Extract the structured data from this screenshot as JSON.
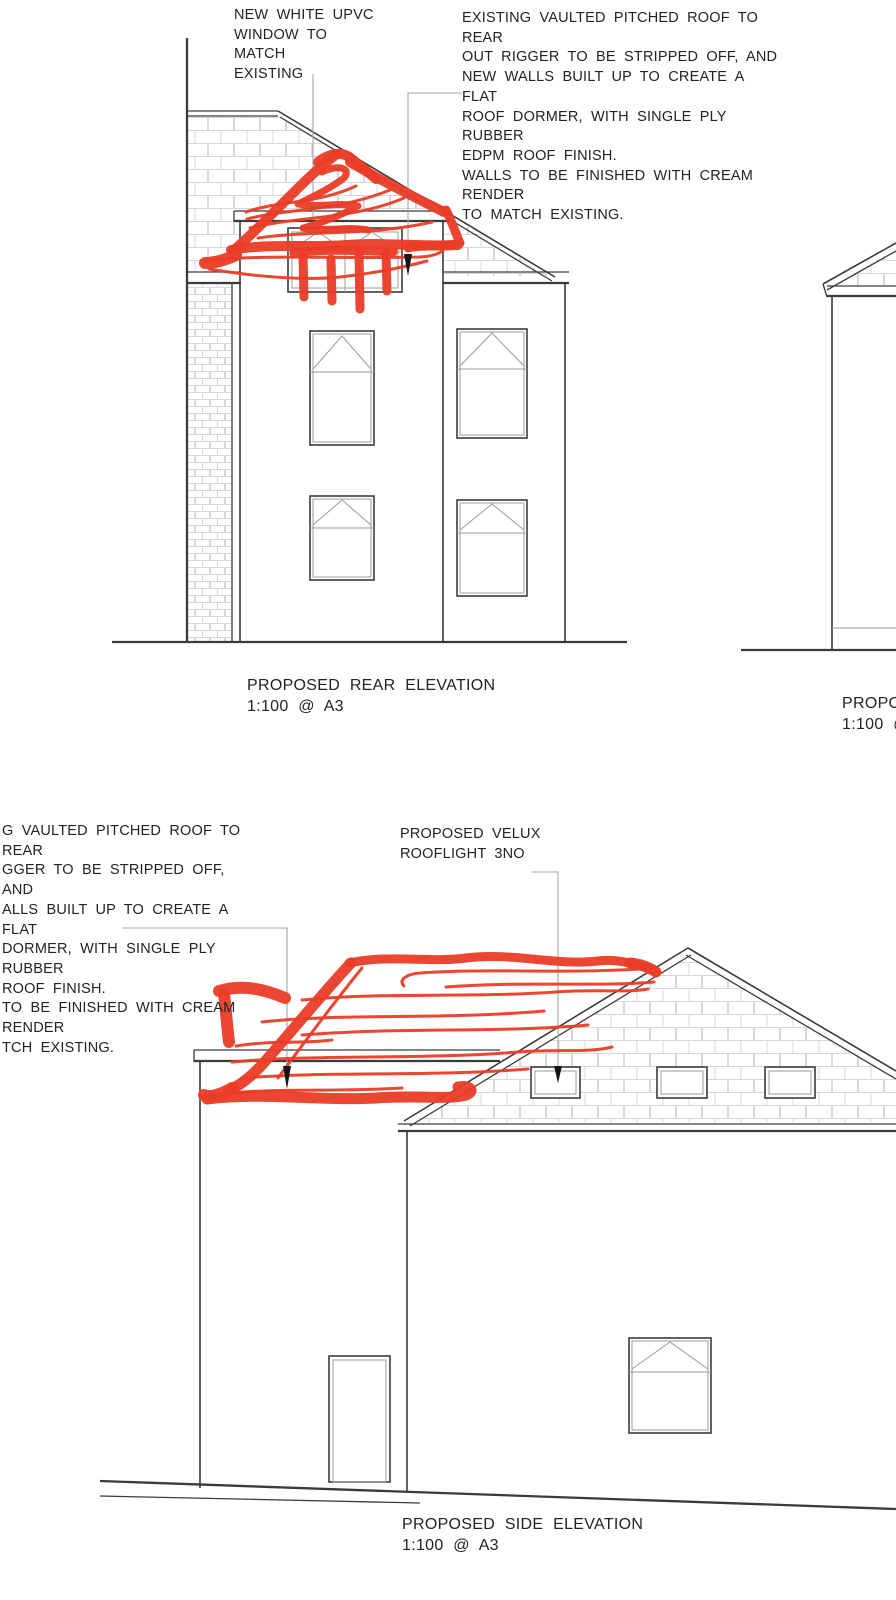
{
  "annotations": {
    "rear_window_note": "NEW WHITE UPVC\nWINDOW TO MATCH\nEXISTING",
    "rear_roof_note": "EXISTING VAULTED PITCHED ROOF TO REAR\nOUT RIGGER TO BE STRIPPED OFF, AND\nNEW WALLS BUILT UP TO CREATE A FLAT\nROOF DORMER, WITH SINGLE PLY RUBBER\nEDPM ROOF FINISH.\nWALLS TO BE FINISHED WITH CREAM RENDER\nTO MATCH EXISTING.",
    "side_roof_note": "G VAULTED PITCHED ROOF TO REAR\nGGER TO BE STRIPPED OFF, AND\nALLS BUILT UP TO CREATE A FLAT\nDORMER, WITH SINGLE PLY RUBBER\nROOF FINISH.\nTO BE FINISHED WITH CREAM RENDER\nTCH EXISTING.",
    "velux_note": "PROPOSED VELUX\nROOFLIGHT 3NO"
  },
  "titles": {
    "rear": {
      "name": "PROPOSED REAR ELEVATION",
      "scale": "1:100 @ A3"
    },
    "side": {
      "name": "PROPOSED SIDE ELEVATION",
      "scale": "1:100 @ A3"
    },
    "right_partial": {
      "name": "PROPOSE",
      "scale": "1:100 @"
    }
  },
  "colors": {
    "annotation_red": "#ea3c27",
    "line_dark": "#3b3b3b",
    "line_light": "#d8d8d8",
    "leader_gray": "#a6a6a6",
    "background": "#ffffff"
  }
}
